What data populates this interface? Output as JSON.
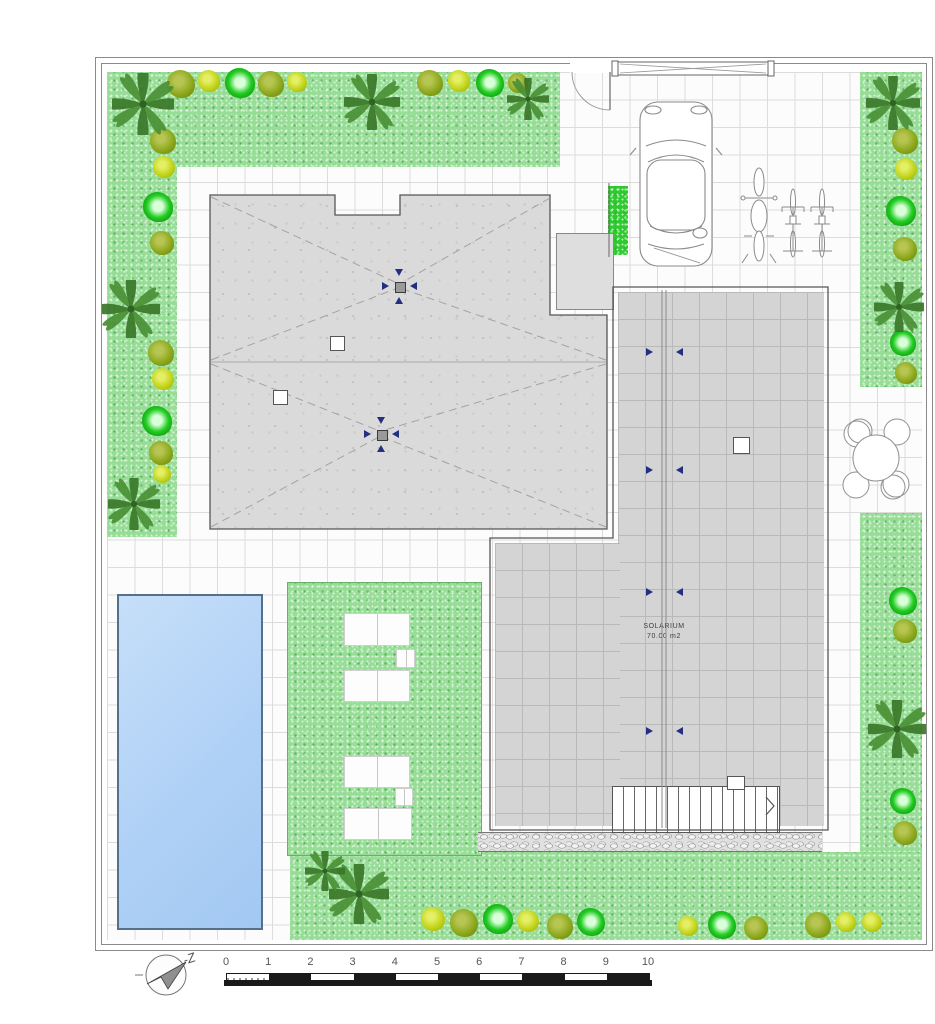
{
  "plan": {
    "compass_label": "-Z",
    "solarium": {
      "name": "SOLARIUM",
      "area": "70.00 m2",
      "joint_arrow_ys": [
        352,
        470,
        592,
        731
      ]
    },
    "scale_bar": {
      "unit_labels": [
        "0",
        "1",
        "2",
        "3",
        "4",
        "5",
        "6",
        "7",
        "8",
        "9",
        "10"
      ]
    },
    "colors": {
      "grass": "#97dc97",
      "roof_gray": "#dadada",
      "solarium_gray": "#d4d4d4",
      "pool_blue": "#aecff5",
      "pool_border": "#55708c",
      "hedge_green": "#2ecb2e",
      "bush_olive": "#8faa1e",
      "bush_lime": "#c3d51c",
      "bush_bright": "#23cd23",
      "palm_green": "#3d7c2e",
      "drain_arrow_blue": "#23307f",
      "wall_line": "#8a8a8a"
    },
    "roof": {
      "drains": [
        {
          "x": 399,
          "y": 286
        },
        {
          "x": 381,
          "y": 434
        }
      ],
      "vents": [
        {
          "x": 330,
          "y": 336
        },
        {
          "x": 273,
          "y": 390
        }
      ]
    },
    "solarium_vent": {
      "x": 733,
      "y": 437
    },
    "furniture": {
      "loungers": [
        {
          "x": 344,
          "y": 613,
          "w": 64,
          "h": 31
        },
        {
          "x": 396,
          "y": 649,
          "w": 17,
          "h": 17
        },
        {
          "x": 344,
          "y": 670,
          "w": 64,
          "h": 30
        },
        {
          "x": 344,
          "y": 756,
          "w": 64,
          "h": 30
        },
        {
          "x": 395,
          "y": 788,
          "w": 16,
          "h": 16
        },
        {
          "x": 344,
          "y": 808,
          "w": 66,
          "h": 30
        }
      ]
    },
    "landscape": {
      "palms": [
        {
          "x": 143,
          "y": 104,
          "s": 62
        },
        {
          "x": 372,
          "y": 102,
          "s": 56
        },
        {
          "x": 528,
          "y": 99,
          "s": 42
        },
        {
          "x": 131,
          "y": 309,
          "s": 58
        },
        {
          "x": 134,
          "y": 504,
          "s": 52
        },
        {
          "x": 893,
          "y": 103,
          "s": 54
        },
        {
          "x": 899,
          "y": 307,
          "s": 50
        },
        {
          "x": 897,
          "y": 729,
          "s": 58
        },
        {
          "x": 359,
          "y": 894,
          "s": 60
        },
        {
          "x": 325,
          "y": 871,
          "s": 40
        }
      ],
      "bushes": [
        {
          "x": 181,
          "y": 84,
          "r": 14,
          "c": "olive"
        },
        {
          "x": 209,
          "y": 81,
          "r": 11,
          "c": "lime"
        },
        {
          "x": 240,
          "y": 83,
          "r": 15,
          "c": "bright"
        },
        {
          "x": 271,
          "y": 84,
          "r": 13,
          "c": "olive"
        },
        {
          "x": 297,
          "y": 82,
          "r": 10,
          "c": "lime"
        },
        {
          "x": 430,
          "y": 83,
          "r": 13,
          "c": "olive"
        },
        {
          "x": 459,
          "y": 81,
          "r": 11,
          "c": "lime"
        },
        {
          "x": 490,
          "y": 83,
          "r": 14,
          "c": "bright"
        },
        {
          "x": 518,
          "y": 83,
          "r": 10,
          "c": "olive"
        },
        {
          "x": 163,
          "y": 141,
          "r": 13,
          "c": "olive"
        },
        {
          "x": 164,
          "y": 167,
          "r": 11,
          "c": "lime"
        },
        {
          "x": 158,
          "y": 207,
          "r": 15,
          "c": "bright"
        },
        {
          "x": 162,
          "y": 243,
          "r": 12,
          "c": "olive"
        },
        {
          "x": 161,
          "y": 353,
          "r": 13,
          "c": "olive"
        },
        {
          "x": 163,
          "y": 379,
          "r": 11,
          "c": "lime"
        },
        {
          "x": 157,
          "y": 421,
          "r": 15,
          "c": "bright"
        },
        {
          "x": 161,
          "y": 453,
          "r": 12,
          "c": "olive"
        },
        {
          "x": 162,
          "y": 474,
          "r": 9,
          "c": "lime"
        },
        {
          "x": 905,
          "y": 141,
          "r": 13,
          "c": "olive"
        },
        {
          "x": 906,
          "y": 169,
          "r": 11,
          "c": "lime"
        },
        {
          "x": 901,
          "y": 211,
          "r": 15,
          "c": "bright"
        },
        {
          "x": 905,
          "y": 249,
          "r": 12,
          "c": "olive"
        },
        {
          "x": 903,
          "y": 343,
          "r": 13,
          "c": "bright"
        },
        {
          "x": 906,
          "y": 373,
          "r": 11,
          "c": "olive"
        },
        {
          "x": 903,
          "y": 601,
          "r": 14,
          "c": "bright"
        },
        {
          "x": 905,
          "y": 631,
          "r": 12,
          "c": "olive"
        },
        {
          "x": 903,
          "y": 801,
          "r": 13,
          "c": "bright"
        },
        {
          "x": 905,
          "y": 833,
          "r": 12,
          "c": "olive"
        },
        {
          "x": 872,
          "y": 922,
          "r": 10,
          "c": "lime"
        },
        {
          "x": 433,
          "y": 919,
          "r": 12,
          "c": "lime"
        },
        {
          "x": 464,
          "y": 923,
          "r": 14,
          "c": "olive"
        },
        {
          "x": 498,
          "y": 919,
          "r": 15,
          "c": "bright"
        },
        {
          "x": 528,
          "y": 921,
          "r": 11,
          "c": "lime"
        },
        {
          "x": 560,
          "y": 926,
          "r": 13,
          "c": "olive"
        },
        {
          "x": 591,
          "y": 922,
          "r": 14,
          "c": "bright"
        },
        {
          "x": 688,
          "y": 926,
          "r": 10,
          "c": "lime"
        },
        {
          "x": 722,
          "y": 925,
          "r": 14,
          "c": "bright"
        },
        {
          "x": 756,
          "y": 928,
          "r": 12,
          "c": "olive"
        },
        {
          "x": 818,
          "y": 925,
          "r": 13,
          "c": "olive"
        },
        {
          "x": 846,
          "y": 922,
          "r": 10,
          "c": "lime"
        }
      ]
    }
  }
}
